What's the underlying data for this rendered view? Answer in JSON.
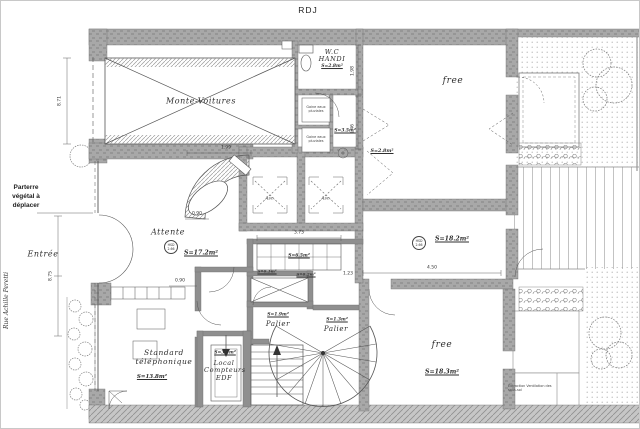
{
  "title": "RDJ",
  "street": "Rue Achille Peretti",
  "annotations": {
    "parterre": "Parterre végétal à déplacer",
    "entree": "Entrée",
    "extraction": "Extraction Ventilation des sous-sol"
  },
  "rooms": {
    "monte_voitures": {
      "name": "Monte-Voitures"
    },
    "attente": {
      "name": "Attente",
      "area": "S=17.2m²"
    },
    "wc_handi": {
      "name": "W.C HANDI",
      "area": "S=2.8m²"
    },
    "gaine_1": {
      "name": "Gaine eaux pluviales"
    },
    "gaine_2": {
      "name": "Gaine eaux pluviales"
    },
    "local_3_5": {
      "area": "S=3.5m²"
    },
    "sas": {
      "area": "S=2.8m²"
    },
    "free_top": {
      "name": "free"
    },
    "hall": {
      "area": "S=18.2m²"
    },
    "free_bottom": {
      "name": "free",
      "area": "S=18.3m²"
    },
    "palier_left": {
      "name": "Palier",
      "area": "S=1.9m²"
    },
    "palier_right": {
      "name": "Palier",
      "area": "S=1.3m²"
    },
    "local_edf": {
      "name": "Local Compteurs EDF",
      "area": "S=3.4m²"
    },
    "standard": {
      "name": "Standard téléphonique",
      "area": "S=13.8m²"
    },
    "skylight": {
      "area": "S=6.5m²"
    },
    "gaine_3": {
      "area": "S=0.3m²"
    },
    "gaine_4": {
      "area": "S=0.2m²"
    },
    "asc_1": {
      "name": "Asc."
    },
    "asc_2": {
      "name": "Asc."
    }
  },
  "markers": {
    "hsd_1": {
      "top": "HSD",
      "bottom": "2.66"
    },
    "hsd_2": {
      "top": "HSD",
      "bottom": "2.66"
    }
  },
  "dimensions": {
    "mv_height": "8.71",
    "facade": "8.75",
    "desk": "1.99",
    "d090a": "0.90",
    "d090b": "0.90",
    "skylight": "3.73",
    "d123": "1.23",
    "hall_w": "4.50",
    "wc_a": "1.98",
    "wc_b": "1.46"
  },
  "colors": {
    "wall": "#a8a8a8",
    "line": "#3c3c3c",
    "paper": "#ffffff"
  }
}
